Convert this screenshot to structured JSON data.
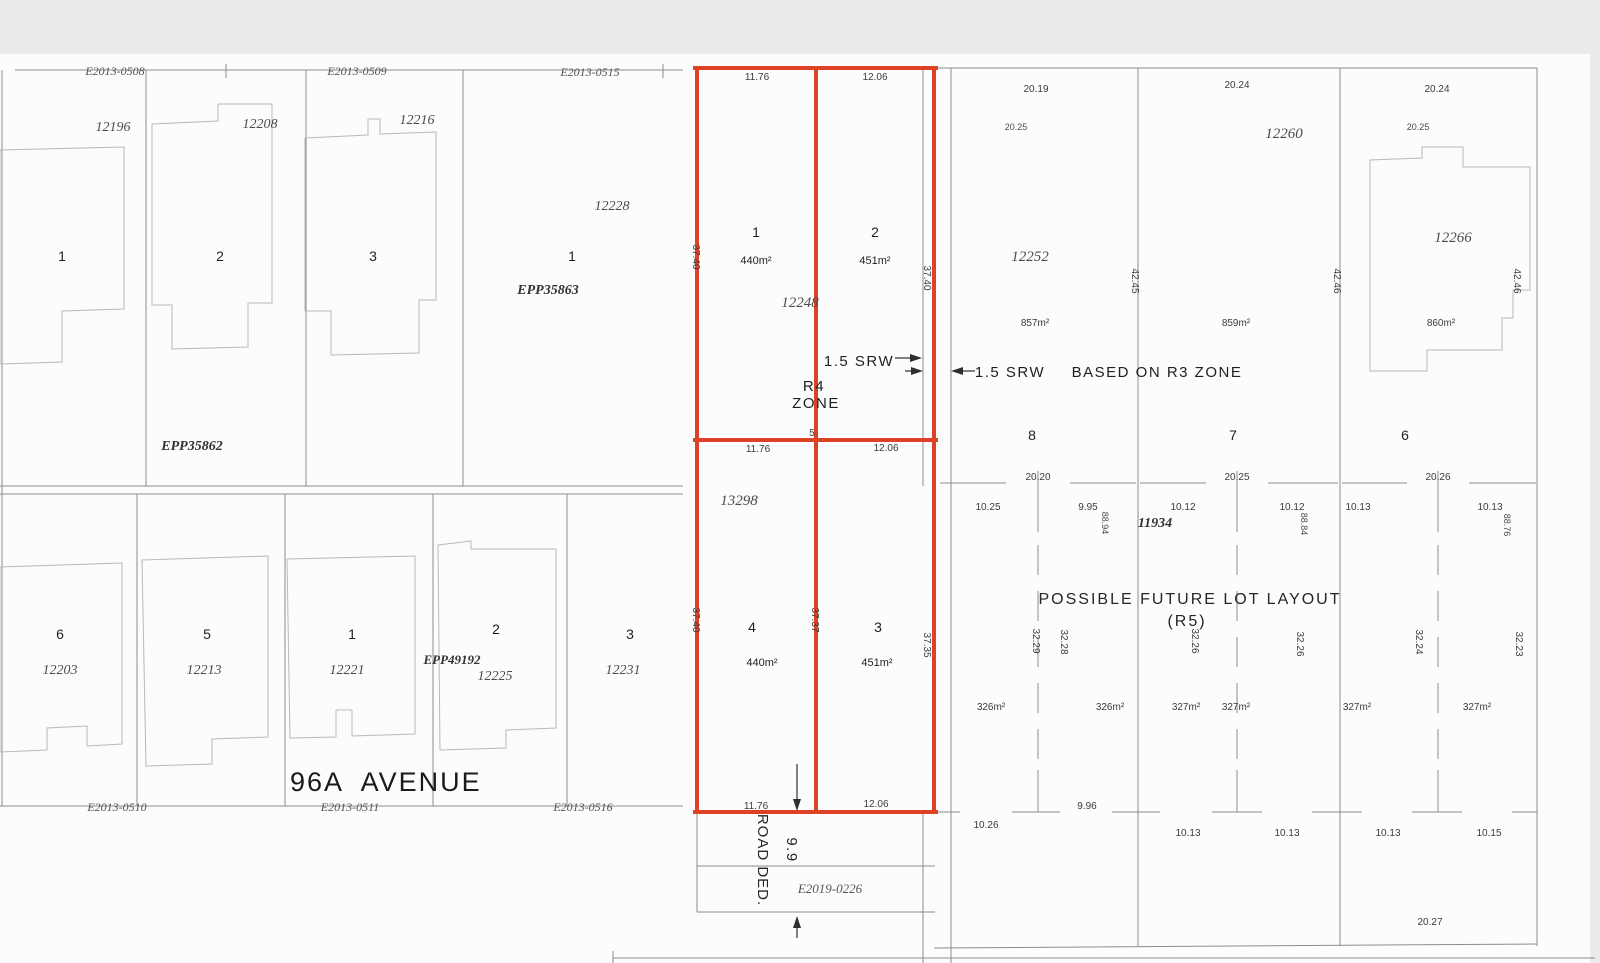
{
  "colors": {
    "red": "#dd4126",
    "boundary": "#8c8c8c",
    "house": "#b9b9b9",
    "paper": "#fcfcfc",
    "background": "#ebebeb",
    "ink": "#2f2f2f"
  },
  "plan_refs": {
    "top_left": "E2013-0508",
    "top_center": "E2013-0509",
    "top_right": "E2013-0515",
    "bottom_left": "E2013-0510",
    "bottom_center": "E2013-0511",
    "bottom_right": "E2013-0516",
    "road": "E2019-0226"
  },
  "street": {
    "name": "96A AVENUE",
    "road_dedication": "ROAD DED.",
    "road_width": "9.9"
  },
  "upper_left_block": {
    "plan_label": "EPP35862",
    "lots": [
      {
        "number": "1",
        "address": "12196"
      },
      {
        "number": "2",
        "address": "12208"
      },
      {
        "number": "3",
        "address": "12216"
      },
      {
        "number": "1",
        "address": "12228",
        "plan": "EPP35863"
      }
    ]
  },
  "lower_left_block": {
    "lots": [
      {
        "number": "6",
        "address": "12203"
      },
      {
        "number": "5",
        "address": "12213"
      },
      {
        "number": "1",
        "address": "12221"
      },
      {
        "number": "2",
        "address": "12225",
        "plan": "EPP49192"
      },
      {
        "number": "3",
        "address": "12231"
      }
    ]
  },
  "red_subdivision": {
    "address_north": "12248",
    "address_south": "13298",
    "zone_line1": "R4",
    "zone_line2": "ZONE",
    "corner_mark": "5",
    "lots": [
      {
        "number": "1",
        "area": "440m²"
      },
      {
        "number": "2",
        "area": "451m²"
      },
      {
        "number": "3",
        "area": "451m²"
      },
      {
        "number": "4",
        "area": "440m²"
      }
    ],
    "dims": {
      "top_w1": "11.76",
      "top_w2": "12.06",
      "mid_w1": "11.76",
      "mid_w2": "12.06",
      "bot_w1": "11.76",
      "bot_w2": "12.06",
      "left_d_north": "37.40",
      "left_d_south": "37.40",
      "mid_d_south": "37.37",
      "right_d_north": "37.40",
      "right_d_south": "37.35"
    }
  },
  "srw": {
    "left_label": "1.5 SRW",
    "right_label": "1.5 SRW",
    "zone_note": "BASED ON R3 ZONE"
  },
  "r3_block": {
    "lots": [
      {
        "number": "8",
        "address": "12252",
        "area": "857m²",
        "front": "20.19",
        "front_inner": "20.25",
        "depth": "42.45"
      },
      {
        "number": "7",
        "address": "12260",
        "area": "859m²",
        "front": "20.24",
        "depth": "42.46"
      },
      {
        "number": "6",
        "address": "12266",
        "area": "860m²",
        "front": "20.24",
        "front_inner": "20.25",
        "depth": "42.46"
      }
    ]
  },
  "future_layout": {
    "title": "POSSIBLE FUTURE LOT LAYOUT",
    "subtitle": "(R5)",
    "address": "11934",
    "top_dims": [
      "20.20",
      "20.25",
      "20.26"
    ],
    "half_dims": [
      "10.25",
      "9.95",
      "10.12",
      "10.12",
      "10.13",
      "10.13"
    ],
    "side_dims": [
      "88.94",
      "88.84",
      "88.76"
    ],
    "mid_depths": [
      "32.29",
      "32.28",
      "32.26",
      "32.26",
      "32.24",
      "32.23"
    ],
    "areas": [
      "326m²",
      "326m²",
      "327m²",
      "327m²",
      "327m²",
      "327m²"
    ],
    "bottom_dims": [
      "10.26",
      "9.96",
      "10.13",
      "10.13",
      "10.13",
      "10.15"
    ],
    "south_dim": "20.27"
  }
}
